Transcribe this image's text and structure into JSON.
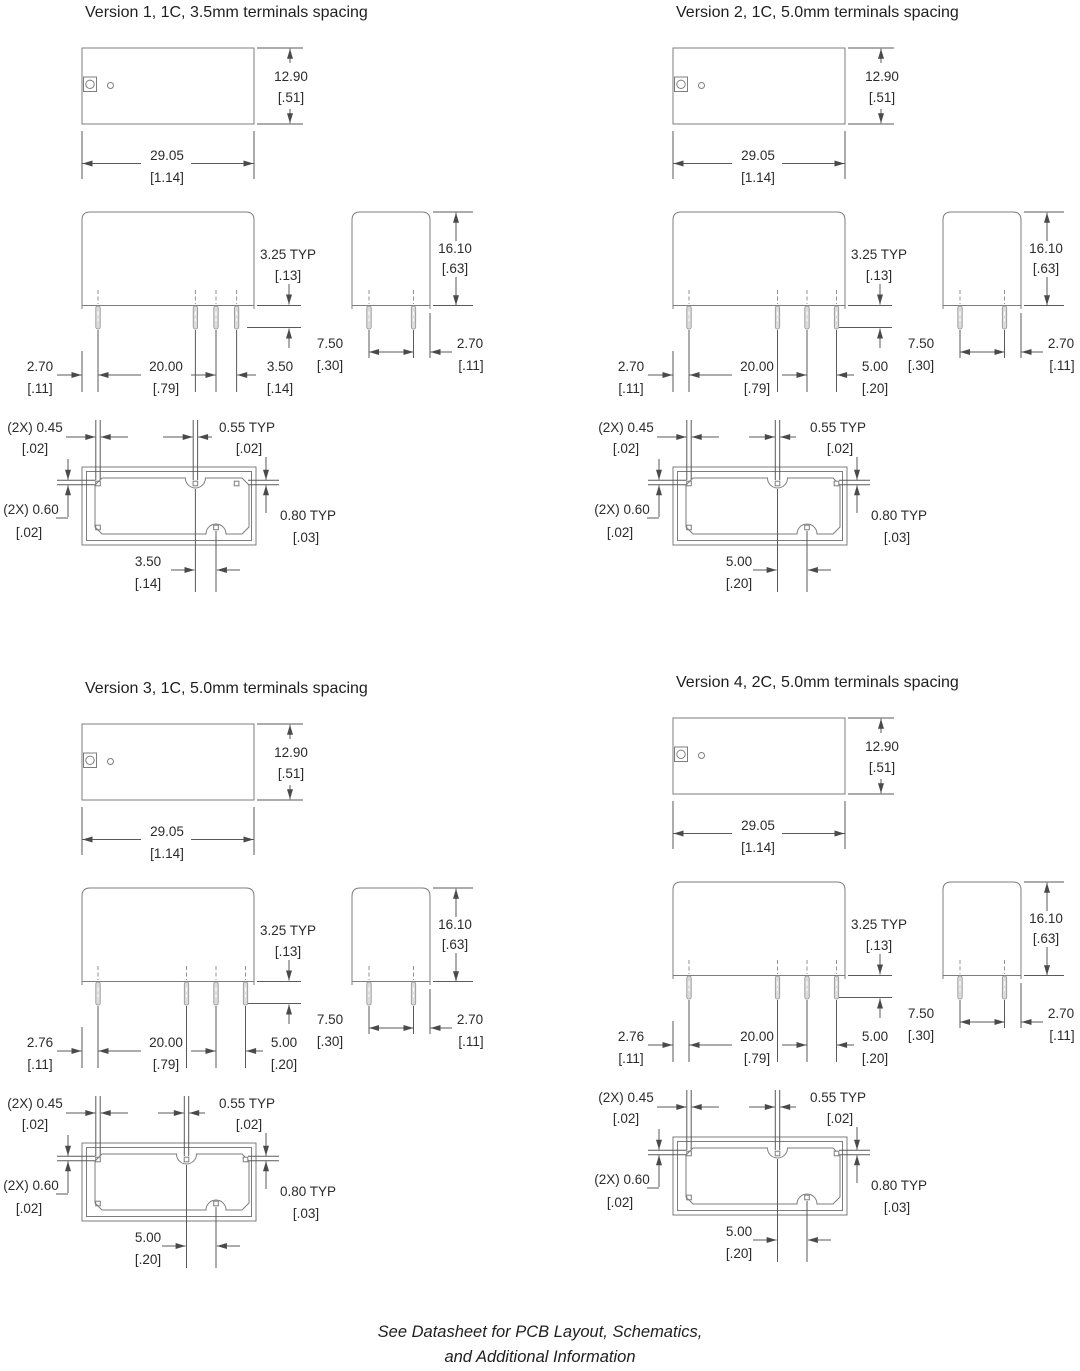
{
  "palette": {
    "drawing_line": "#7d7d7d",
    "dimension_line": "#5a5a5a",
    "text": "#2b2b2b"
  },
  "footer": {
    "line1": "See Datasheet for PCB Layout, Schematics,",
    "line2": "and Additional Information"
  },
  "versions": [
    {
      "title": "Version 1, 1C, 3.5mm terminals spacing",
      "top": {
        "h_mm": "12.90",
        "h_in": "[.51]",
        "w_mm": "29.05",
        "w_in": "[1.14]"
      },
      "front": {
        "shoulder_mm": "3.25 TYP",
        "shoulder_in": "[.13]",
        "left_mm": "2.70",
        "left_in": "[.11]",
        "span_mm": "20.00",
        "span_in": "[.79]",
        "pitch_mm": "3.50",
        "pitch_in": "[.14]"
      },
      "end": {
        "spacing_mm": "7.50",
        "spacing_in": "[.30]",
        "edge_mm": "2.70",
        "edge_in": "[.11]",
        "h_mm": "16.10",
        "h_in": "[.63]"
      },
      "bottom": {
        "slot_w_mm": "(2X) 0.45",
        "slot_w_in": "[.02]",
        "slot_w2_mm": "0.55 TYP",
        "slot_w2_in": "[.02]",
        "slot_h_mm": "(2X) 0.60",
        "slot_h_in": "[.02]",
        "slot_h2_mm": "0.80 TYP",
        "slot_h2_in": "[.03]",
        "pitch_mm": "3.50",
        "pitch_in": "[.14]"
      }
    },
    {
      "title": "Version 2, 1C, 5.0mm terminals spacing",
      "top": {
        "h_mm": "12.90",
        "h_in": "[.51]",
        "w_mm": "29.05",
        "w_in": "[1.14]"
      },
      "front": {
        "shoulder_mm": "3.25 TYP",
        "shoulder_in": "[.13]",
        "left_mm": "2.70",
        "left_in": "[.11]",
        "span_mm": "20.00",
        "span_in": "[.79]",
        "pitch_mm": "5.00",
        "pitch_in": "[.20]"
      },
      "end": {
        "spacing_mm": "7.50",
        "spacing_in": "[.30]",
        "edge_mm": "2.70",
        "edge_in": "[.11]",
        "h_mm": "16.10",
        "h_in": "[.63]"
      },
      "bottom": {
        "slot_w_mm": "(2X) 0.45",
        "slot_w_in": "[.02]",
        "slot_w2_mm": "0.55 TYP",
        "slot_w2_in": "[.02]",
        "slot_h_mm": "(2X) 0.60",
        "slot_h_in": "[.02]",
        "slot_h2_mm": "0.80 TYP",
        "slot_h2_in": "[.03]",
        "pitch_mm": "5.00",
        "pitch_in": "[.20]"
      }
    },
    {
      "title": "Version 3, 1C, 5.0mm terminals spacing",
      "top": {
        "h_mm": "12.90",
        "h_in": "[.51]",
        "w_mm": "29.05",
        "w_in": "[1.14]"
      },
      "front": {
        "shoulder_mm": "3.25 TYP",
        "shoulder_in": "[.13]",
        "left_mm": "2.76",
        "left_in": "[.11]",
        "span_mm": "20.00",
        "span_in": "[.79]",
        "pitch_mm": "5.00",
        "pitch_in": "[.20]"
      },
      "end": {
        "spacing_mm": "7.50",
        "spacing_in": "[.30]",
        "edge_mm": "2.70",
        "edge_in": "[.11]",
        "h_mm": "16.10",
        "h_in": "[.63]"
      },
      "bottom": {
        "slot_w_mm": "(2X) 0.45",
        "slot_w_in": "[.02]",
        "slot_w2_mm": "0.55 TYP",
        "slot_w2_in": "[.02]",
        "slot_h_mm": "(2X) 0.60",
        "slot_h_in": "[.02]",
        "slot_h2_mm": "0.80 TYP",
        "slot_h2_in": "[.03]",
        "pitch_mm": "5.00",
        "pitch_in": "[.20]"
      }
    },
    {
      "title": "Version 4, 2C, 5.0mm terminals spacing",
      "top": {
        "h_mm": "12.90",
        "h_in": "[.51]",
        "w_mm": "29.05",
        "w_in": "[1.14]"
      },
      "front": {
        "shoulder_mm": "3.25 TYP",
        "shoulder_in": "[.13]",
        "left_mm": "2.76",
        "left_in": "[.11]",
        "span_mm": "20.00",
        "span_in": "[.79]",
        "pitch_mm": "5.00",
        "pitch_in": "[.20]"
      },
      "end": {
        "spacing_mm": "7.50",
        "spacing_in": "[.30]",
        "edge_mm": "2.70",
        "edge_in": "[.11]",
        "h_mm": "16.10",
        "h_in": "[.63]"
      },
      "bottom": {
        "slot_w_mm": "(2X) 0.45",
        "slot_w_in": "[.02]",
        "slot_w2_mm": "0.55 TYP",
        "slot_w2_in": "[.02]",
        "slot_h_mm": "(2X) 0.60",
        "slot_h_in": "[.02]",
        "slot_h2_mm": "0.80 TYP",
        "slot_h2_in": "[.03]",
        "pitch_mm": "5.00",
        "pitch_in": "[.20]"
      }
    }
  ]
}
